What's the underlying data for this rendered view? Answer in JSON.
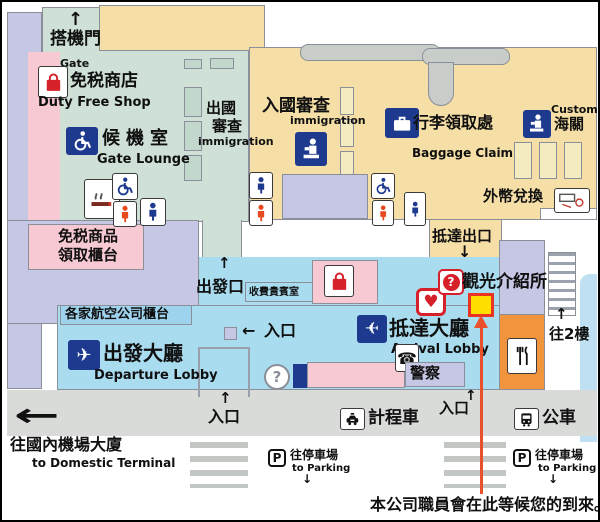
{
  "note": "本公司職員會在此等候您的到來。",
  "arrows": {
    "up": "↑",
    "down": "↓",
    "left": "←"
  },
  "glyphs": {
    "plane": "✈",
    "phone": "☎",
    "heart": "♥",
    "question": "?",
    "parking": "P"
  },
  "labels": {
    "gate": {
      "jp": "搭機門",
      "en": "Gate"
    },
    "duty_free_shop": {
      "jp": "免税商店",
      "en": "Duty Free Shop"
    },
    "gate_lounge": {
      "jp": "候機室",
      "en": "Gate Lounge"
    },
    "departure_immigration": {
      "jp_line1": "出國",
      "jp_line2": "審查",
      "en": "immigration"
    },
    "arrival_immigration": {
      "jp": "入國審查",
      "en": "immigration"
    },
    "baggage_claim": {
      "jp": "行李領取處",
      "en": "Baggage Claim"
    },
    "customs": {
      "en": "Customs",
      "jp": "海關"
    },
    "currency_exchange": {
      "jp": "外幣兌換"
    },
    "arrival_exit": {
      "jp": "抵達出口"
    },
    "duty_free_pickup": {
      "jp_line1": "免税商品",
      "jp_line2": "領取櫃台"
    },
    "departure_gate": {
      "jp": "出發口"
    },
    "paid_vip_lounge": {
      "jp": "收費貴賓室"
    },
    "airline_counters": {
      "jp": "各家航空公司櫃台"
    },
    "departure_lobby": {
      "jp": "出發大廳",
      "en": "Departure Lobby"
    },
    "arrival_lobby": {
      "jp": "抵達大廳",
      "en": "Arrival Lobby"
    },
    "police": {
      "jp": "警察"
    },
    "tourist_info": {
      "jp": "觀光介紹所"
    },
    "to_2f": {
      "jp": "往2樓"
    },
    "entrance": {
      "jp": "入口"
    },
    "taxi": {
      "jp": "計程車"
    },
    "bus": {
      "jp": "公車"
    },
    "to_domestic": {
      "jp": "往國內機場大廈",
      "en": "to Domestic Terminal"
    },
    "to_parking": {
      "jp": "往停車場",
      "en": "to Parking"
    }
  },
  "colors": {
    "lavender": "#c6c7e4",
    "sage": "#cfe0d6",
    "tan": "#f6dfa6",
    "pink": "#f7c9d3",
    "lobby_cyan": "#aadcf0",
    "counter_band": "#9ed3ee",
    "orange": "#f0953e",
    "road_gray": "#d8dbd8",
    "booth_yellow": "#f4ecc0",
    "marker_yellow": "#ffdf00",
    "marker_red": "#e93323",
    "guide_line_red": "#e8512b",
    "icon_navy": "#1e3a8f",
    "icon_red": "#d6202a"
  }
}
